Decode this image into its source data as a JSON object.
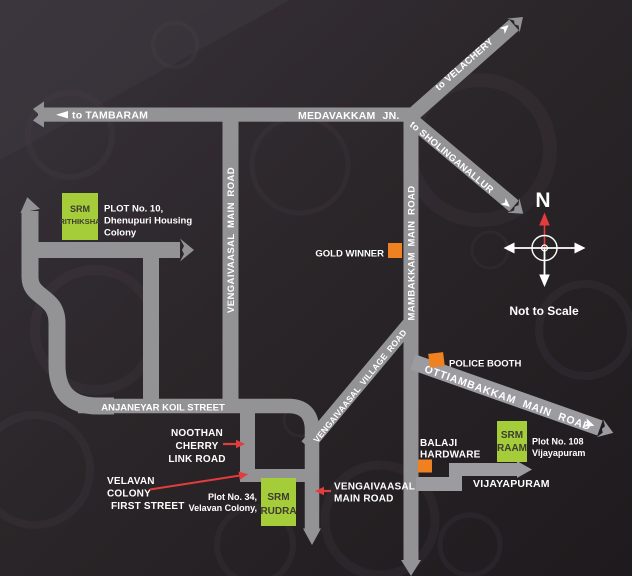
{
  "colors": {
    "background": "#292428",
    "road_gray": "#939396",
    "road_light": "#9c9ca0",
    "site_green": "#a5cd39",
    "marker_orange": "#f08120",
    "accent_red": "#e23c3d",
    "label_white": "#ffffff",
    "site_text_dark": "#3c3c33"
  },
  "roads": {
    "to_tambaram": "to TAMBARAM",
    "medavakkam_jn": "MEDAVAKKAM JN.",
    "to_velachery": "to VELACHERY",
    "to_sholinganallur": "to SHOLINGANALLUR",
    "vengaivaasal_main": "VENGAIVAASAL MAIN ROAD",
    "mambakkam_main": "MAMBAKKAM MAIN ROAD",
    "vengaivaasal_village": "VENGAIVAASAL VILLAGE ROAD",
    "ottiambakkam_main": "OTTIAMBAKKAM MAIN ROAD",
    "anjaneyar_koil": "ANJANEYAR KOIL STREET",
    "vijayapuram": "VIJAYAPURAM"
  },
  "callouts": {
    "noothan_cherry": {
      "line1": "NOOTHAN",
      "line2": "CHERRY",
      "line3": "LINK ROAD"
    },
    "velavan_colony": {
      "line1": "VELAVAN",
      "line2": "COLONY",
      "line3": "FIRST STREET"
    },
    "vengaivaasal_main_south": {
      "line1": "VENGAIVAASAL",
      "line2": "MAIN ROAD"
    }
  },
  "landmarks": {
    "gold_winner": "GOLD WINNER",
    "police_booth": "POLICE BOOTH",
    "balaji_hardware": {
      "line1": "BALAJI",
      "line2": "HARDWARE"
    }
  },
  "sites": {
    "rithiksha": {
      "brand": "SRM",
      "name": "RITHIKSHA",
      "plot_line1": "PLOT No. 10,",
      "plot_line2": "Dhenupuri Housing",
      "plot_line3": "Colony"
    },
    "rudra": {
      "brand": "SRM",
      "name": "RUDRA",
      "plot_line1": "Plot No. 34,",
      "plot_line2": "Velavan Colony,"
    },
    "raam": {
      "brand": "SRM",
      "name": "RAAM",
      "plot_line1": "Plot No. 108",
      "plot_line2": "Vijayapuram"
    }
  },
  "compass": {
    "north": "N"
  },
  "notes": {
    "scale": "Not to Scale"
  }
}
